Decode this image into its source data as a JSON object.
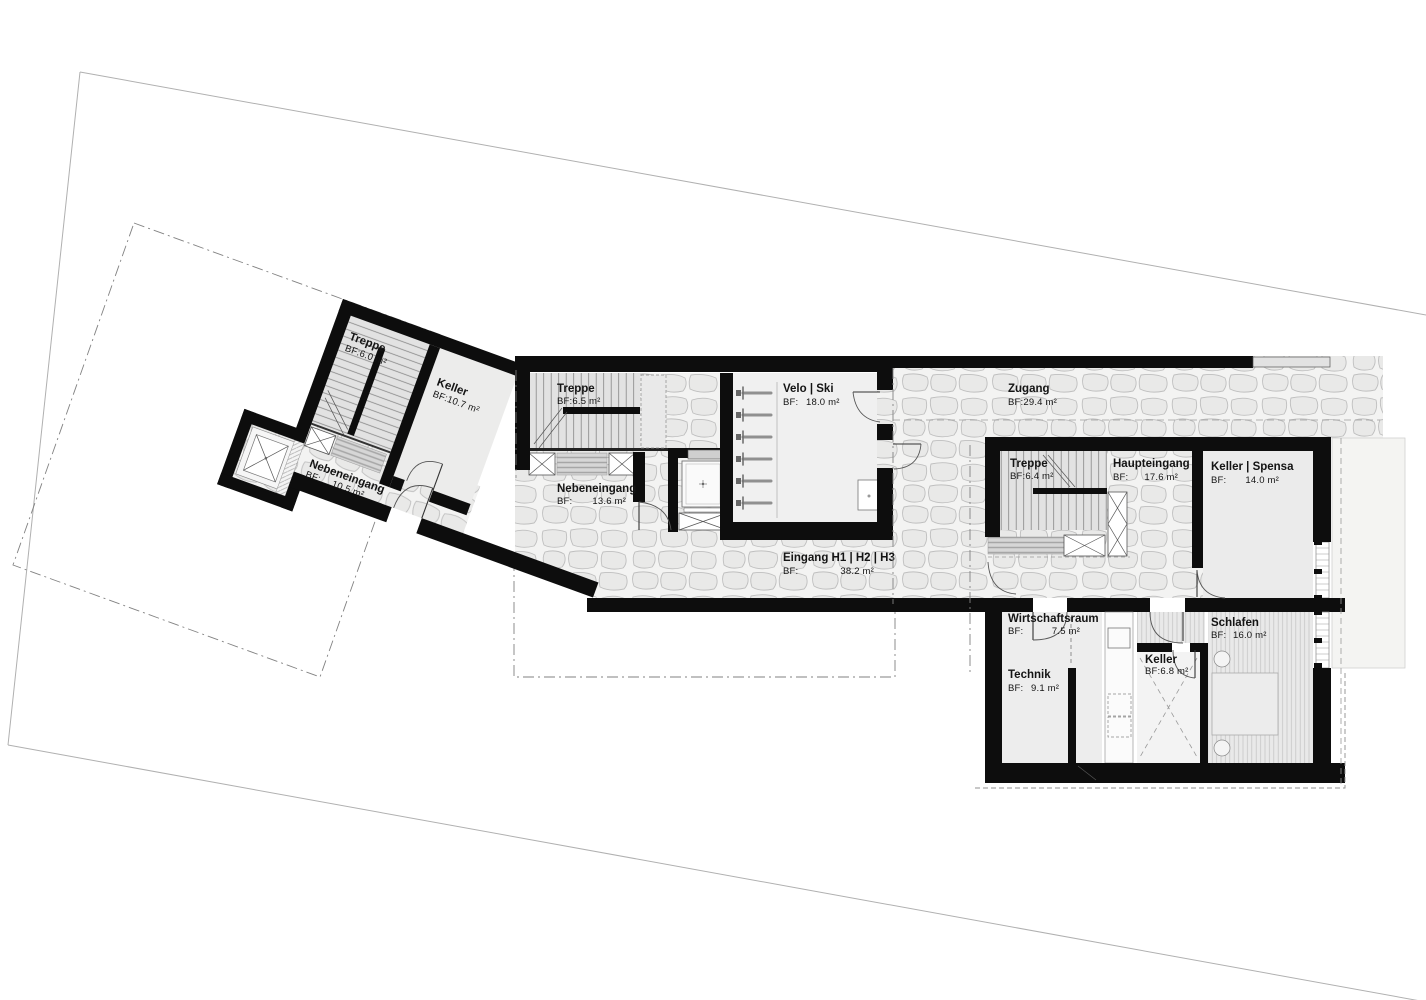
{
  "plan": {
    "type": "architectural-floor-plan",
    "rooms": [
      {
        "name": "Treppe",
        "bf": "BF:6.0 m²"
      },
      {
        "name": "Keller",
        "bf": "BF:10.7 m²"
      },
      {
        "name": "Nebeneingang",
        "bf": "BF:",
        "area": "10.5 m²"
      },
      {
        "name": "Treppe",
        "bf": "BF:6.5 m²"
      },
      {
        "name": "Nebeneingang",
        "bf": "BF:",
        "area": "13.6 m²"
      },
      {
        "name": "Velo | Ski",
        "bf": "BF:",
        "area": "18.0 m²"
      },
      {
        "name": "Zugang",
        "bf": "BF:29.4 m²"
      },
      {
        "name": "Eingang H1 | H2 | H3",
        "bf": "BF:",
        "area": "38.2 m²"
      },
      {
        "name": "Treppe",
        "bf": "BF:6.4 m²"
      },
      {
        "name": "Haupteingang",
        "bf": "BF:",
        "area": "17.6 m²"
      },
      {
        "name": "Keller | Spensa",
        "bf": "BF:",
        "area": "14.0 m²"
      },
      {
        "name": "Wirtschaftsraum",
        "bf": "BF:",
        "area": "7.5 m²"
      },
      {
        "name": "Technik",
        "bf": "BF:",
        "area": "9.1 m²"
      },
      {
        "name": "Keller",
        "bf": "BF:6.8 m²"
      },
      {
        "name": "Schlafen",
        "bf": "BF:",
        "area": "16.0 m²"
      }
    ],
    "colors": {
      "wall": "#0d0d0d",
      "room_fill": "#ebebeb",
      "cobble_stone": "#e9e9e8",
      "cobble_joint": "#bfbfbf",
      "hatch_line": "#b4b4b4",
      "mat_fill": "#d4d4d4",
      "boundary_line": "#b0b0b0",
      "setback_line": "#808080"
    }
  }
}
